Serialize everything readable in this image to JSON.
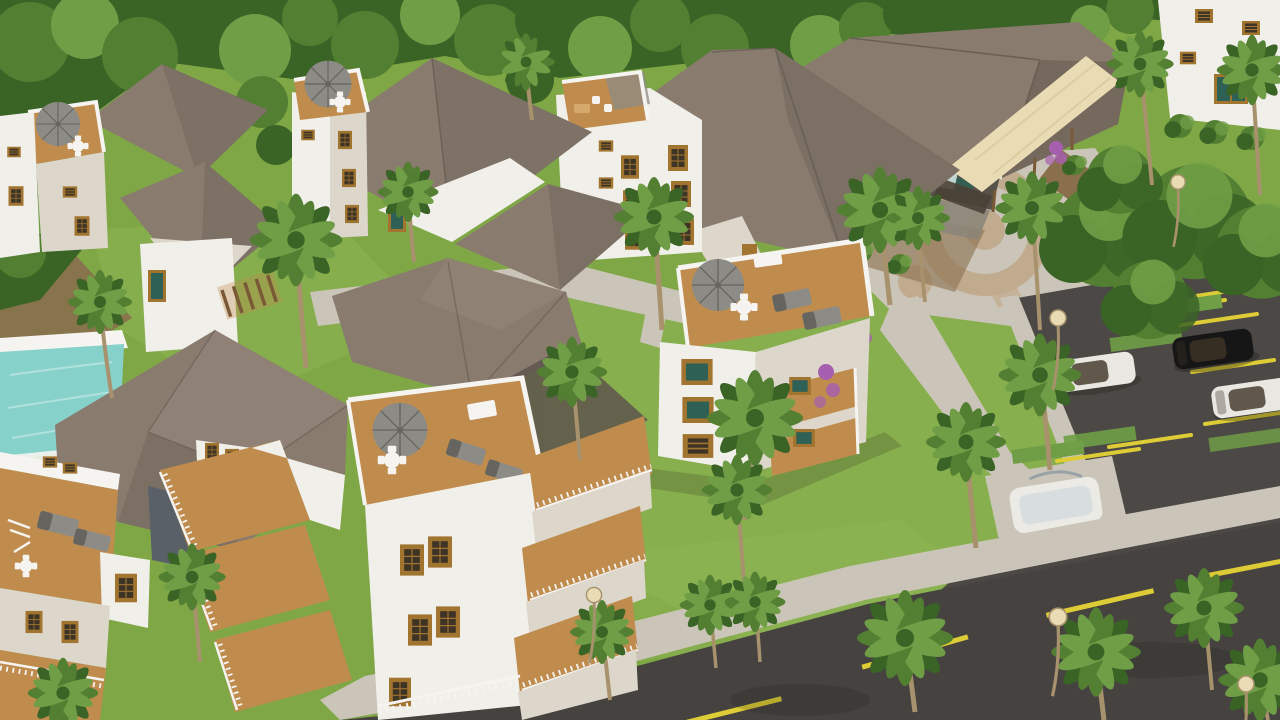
{
  "scene": {
    "title": "Tropical resort residential development - aerial 3D architectural rendering",
    "description": "High-angle aerial 3D architectural rendering of a tropical residential resort: white multi-storey villas with brown tiled hip roofs, rooftop wood-deck terraces with gray parasols, outdoor dining sets and loungers, wooden balconies, a turquoise swimming pool, a large clubhouse with a cream awning, a paved plaza with a circular motif, landscaped lawns with palm trees, a parking lot with three parked cars and yellow stall markings, and an asphalt road with a dashed yellow center line.",
    "camera": "oblique bird's-eye view",
    "objects": {
      "buildings": [
        {
          "name": "villa-top-left",
          "features": [
            "rooftop terrace",
            "parasol",
            "dining set",
            "hip roof"
          ]
        },
        {
          "name": "villa-top-second",
          "features": [
            "rooftop terrace",
            "dark parasol",
            "large hip roof",
            "teal glass door"
          ]
        },
        {
          "name": "apartment-block-top-middle",
          "features": [
            "rooftop terrace",
            "amber grid windows",
            "hip roof wing",
            "gable door"
          ]
        },
        {
          "name": "villa-center",
          "features": [
            "rooftop terrace",
            "parasol",
            "dining set",
            "loungers",
            "teal windows",
            "wood balconies",
            "bougainvillea"
          ]
        },
        {
          "name": "villa-lower-left",
          "features": [
            "large hip roof",
            "roof deck with loungers",
            "slate accent wall",
            "stacked wood balconies"
          ]
        },
        {
          "name": "villa-lower-middle",
          "features": [
            "rooftop terrace",
            "parasol",
            "dining set",
            "loungers",
            "stacked wood balconies"
          ]
        },
        {
          "name": "building-far-right",
          "features": [
            "white facade",
            "amber shutter windows",
            "teal glass door"
          ]
        },
        {
          "name": "clubhouse",
          "features": [
            "large hip roof",
            "cream awning",
            "glass balcony",
            "stone base",
            "entrance"
          ]
        }
      ],
      "amenities": [
        "swimming-pool",
        "plaza-with-circular-paving",
        "spa-pad",
        "pergola",
        "parking-lot",
        "walkways"
      ],
      "vehicles": [
        {
          "type": "suv",
          "color": "black"
        },
        {
          "type": "sedan",
          "color": "white"
        },
        {
          "type": "suv",
          "color": "white"
        }
      ],
      "vegetation": [
        "palm-trees",
        "canopy-trees",
        "shrub-beds",
        "lawns",
        "hedges"
      ],
      "infrastructure": [
        "asphalt-road",
        "dashed-yellow-center-line",
        "sidewalks",
        "street-lamps",
        "yellow-parking-stall-lines",
        "grass-parking-strips"
      ]
    },
    "counts": {
      "residential_buildings": 7,
      "clubhouse": 1,
      "cars": 3,
      "pools": 1,
      "parasols": 5
    },
    "palette": {
      "grass": "#7fa746",
      "grassLight": "#90b756",
      "canopyDark": "#3a6326",
      "canopyMid": "#527f31",
      "canopyLight": "#6f9e46",
      "roofLight": "#a3948a",
      "roofMid": "#897b6e",
      "roofDark": "#5e554c",
      "wallBright": "#f1efe9",
      "wallShade": "#dcd6cb",
      "slate": "#5a6068",
      "wood": "#c08c4e",
      "woodLight": "#d5a96c",
      "frame": "#a1742f",
      "windowGlass": "#3e3425",
      "glassTeal": "#2f6055",
      "pool": "#86d1ca",
      "paving": "#cac5b8",
      "pavingTan": "#c1ab8f",
      "asphalt": "#4b4845",
      "roadAsphalt": "#454240",
      "yellowLine": "#ddcc35",
      "awning": "#e9dcb4",
      "furnGray": "#8d8b85",
      "furnGrayDark": "#66645e",
      "white": "#f5f4f1",
      "purple": "#a55fae",
      "trunk": "#a8926d",
      "dirt": "#8a6f4c",
      "shadow": "#1e1e14",
      "clubWall": "#56524a",
      "stoneBase": "#8c8578",
      "carBlack": "#161616",
      "carWhite": "#e9e7e2",
      "spaWhite": "#eceae4",
      "railGray": "#98a1a5",
      "pergola": "#7a5a36"
    }
  }
}
